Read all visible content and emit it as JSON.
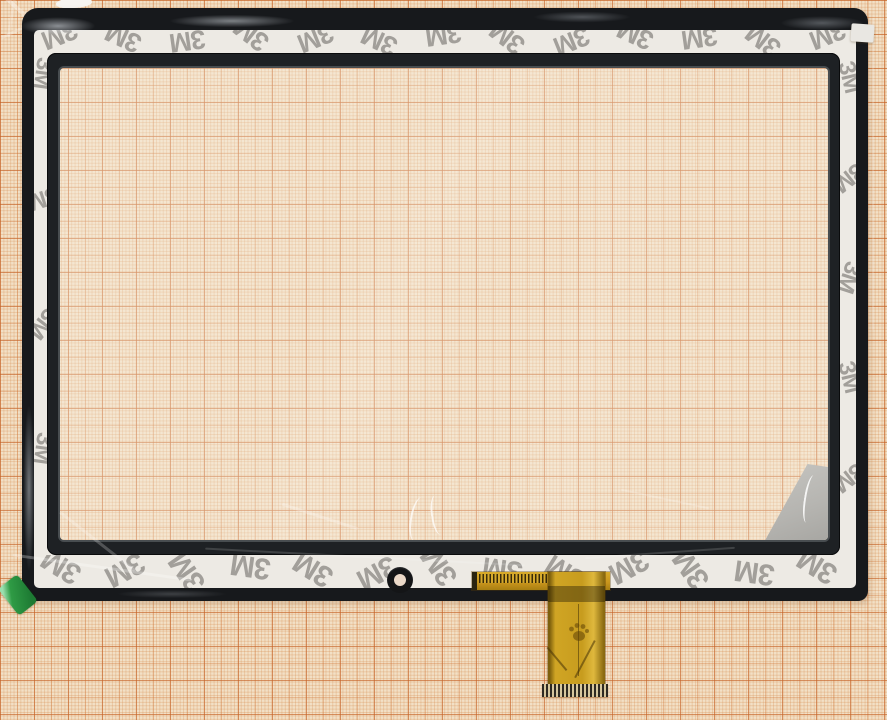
{
  "subject_label": "tablet touchscreen digitizer on graph paper",
  "tape": {
    "brand_label": "3M",
    "logo_color": "#a29f9a",
    "strips": {
      "top": {
        "orientation": "h",
        "count": 13,
        "spacing": 64,
        "offset": -6,
        "font_size": 27,
        "angles": [
          158,
          205,
          172,
          218
        ]
      },
      "bottom": {
        "orientation": "h",
        "count": 13,
        "spacing": 63,
        "offset": -1,
        "font_size": 30,
        "angles": [
          212,
          152,
          235,
          188
        ]
      },
      "left": {
        "orientation": "v",
        "count": 4,
        "spacing": 125,
        "offset": 8,
        "font_size": 24,
        "angles": [
          98,
          162,
          128
        ]
      },
      "right": {
        "orientation": "v",
        "count": 5,
        "spacing": 100,
        "offset": 12,
        "font_size": 24,
        "angles": [
          76,
          142,
          108
        ]
      }
    }
  },
  "colors": {
    "paper-base": "#f2e0c6",
    "panel-black": "#17191c",
    "inner-frame-black": "#1e2124",
    "tape-white": "#edeae4",
    "logo-grey": "#a29f9a",
    "fpc-gold": "#c8941c",
    "fpc-gold-dark": "#8a6a10",
    "sticker-green": "#2f9b45",
    "peel-grey": "#b6b5b1",
    "hole-center": "#ead8c8"
  }
}
